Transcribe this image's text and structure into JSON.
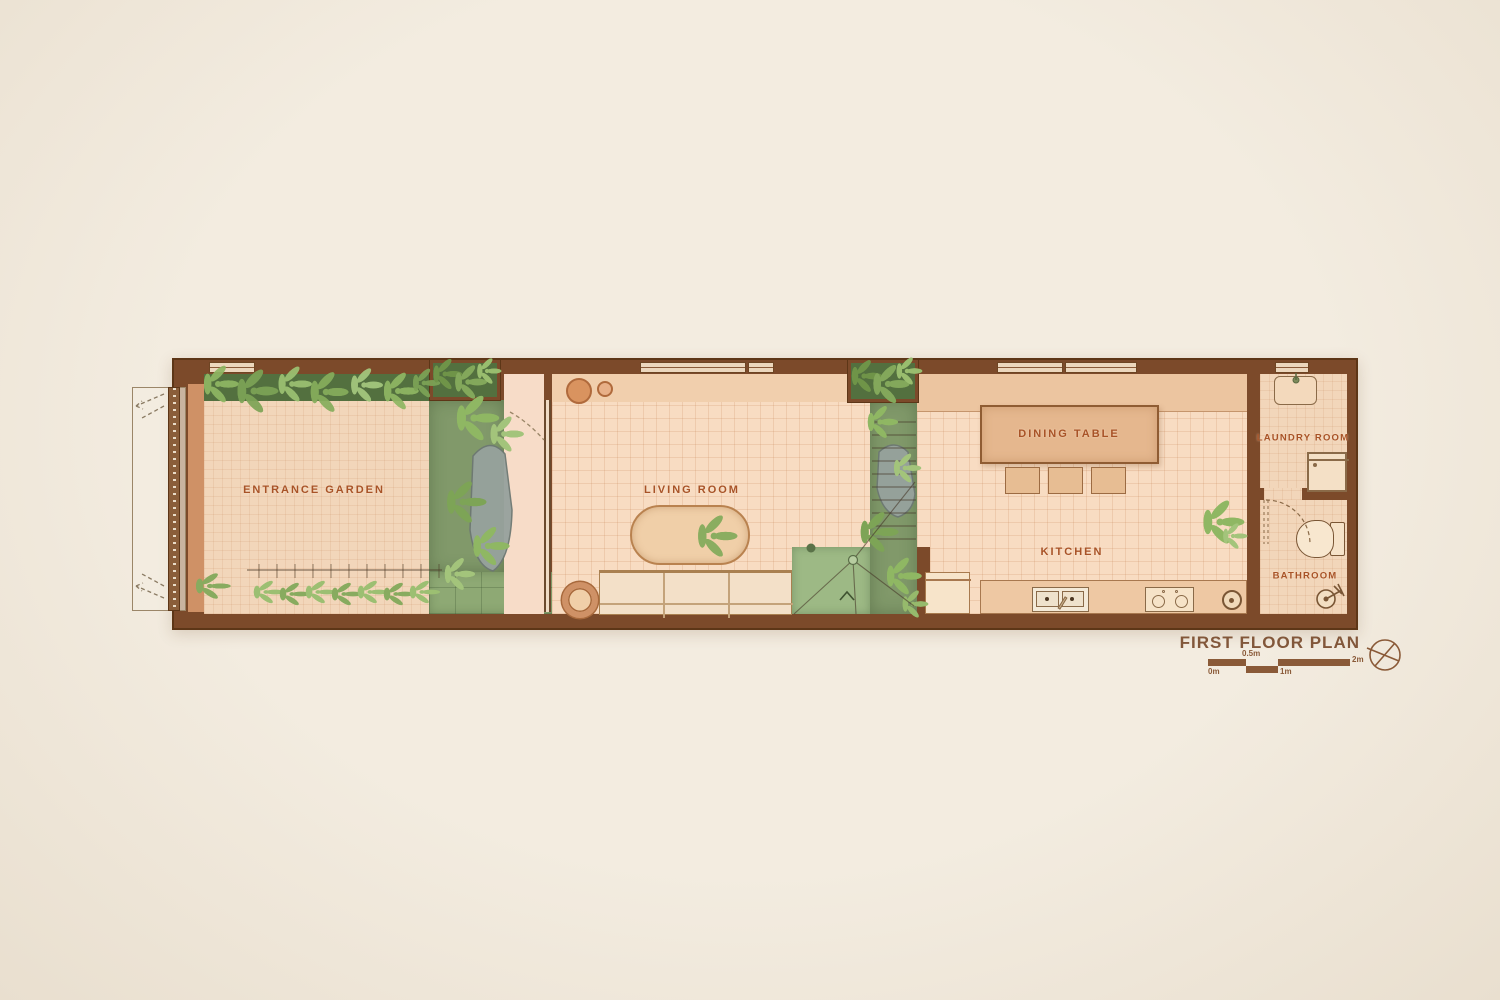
{
  "title": "FIRST FLOOR PLAN",
  "room_labels": {
    "entrance_garden": "ENTRANCE GARDEN",
    "living_room": "LIVING ROOM",
    "dining_table": "DINING TABLE",
    "kitchen": "KITCHEN",
    "laundry_room": "LAUNDRY ROOM",
    "bathroom": "BATHROOM"
  },
  "scale_bar": {
    "labels": [
      "0m",
      "0.5m",
      "1m",
      "2m"
    ]
  },
  "icons": {
    "north_arrow": "circled-cross north symbol"
  },
  "colors": {
    "background": "#f3ece0",
    "wall": "#7c4a2a",
    "terracotta_accent": "#cf9166",
    "floor_tile": "#f8dcc2",
    "courtyard_green": "#81996a",
    "plant_green": "#8fb763",
    "label_text": "#a85327",
    "title_text": "#82573a"
  }
}
